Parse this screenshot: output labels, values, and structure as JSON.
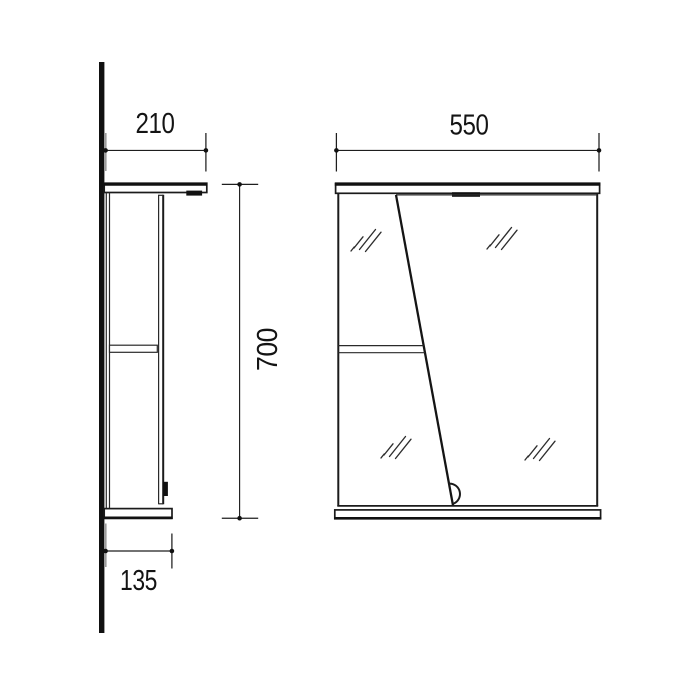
{
  "canvas": {
    "width": 700,
    "height": 700,
    "background": "#ffffff"
  },
  "drawing": {
    "subject": "wall-mounted bathroom mirror cabinet, side and front elevation views",
    "colors": {
      "line": "#1b1b1b",
      "gray_tick": "#9c9c9c",
      "background": "#ffffff"
    }
  },
  "dimensions": {
    "side_top_depth": "210",
    "side_bottom_depth": "135",
    "height": "700",
    "front_width": "550"
  }
}
